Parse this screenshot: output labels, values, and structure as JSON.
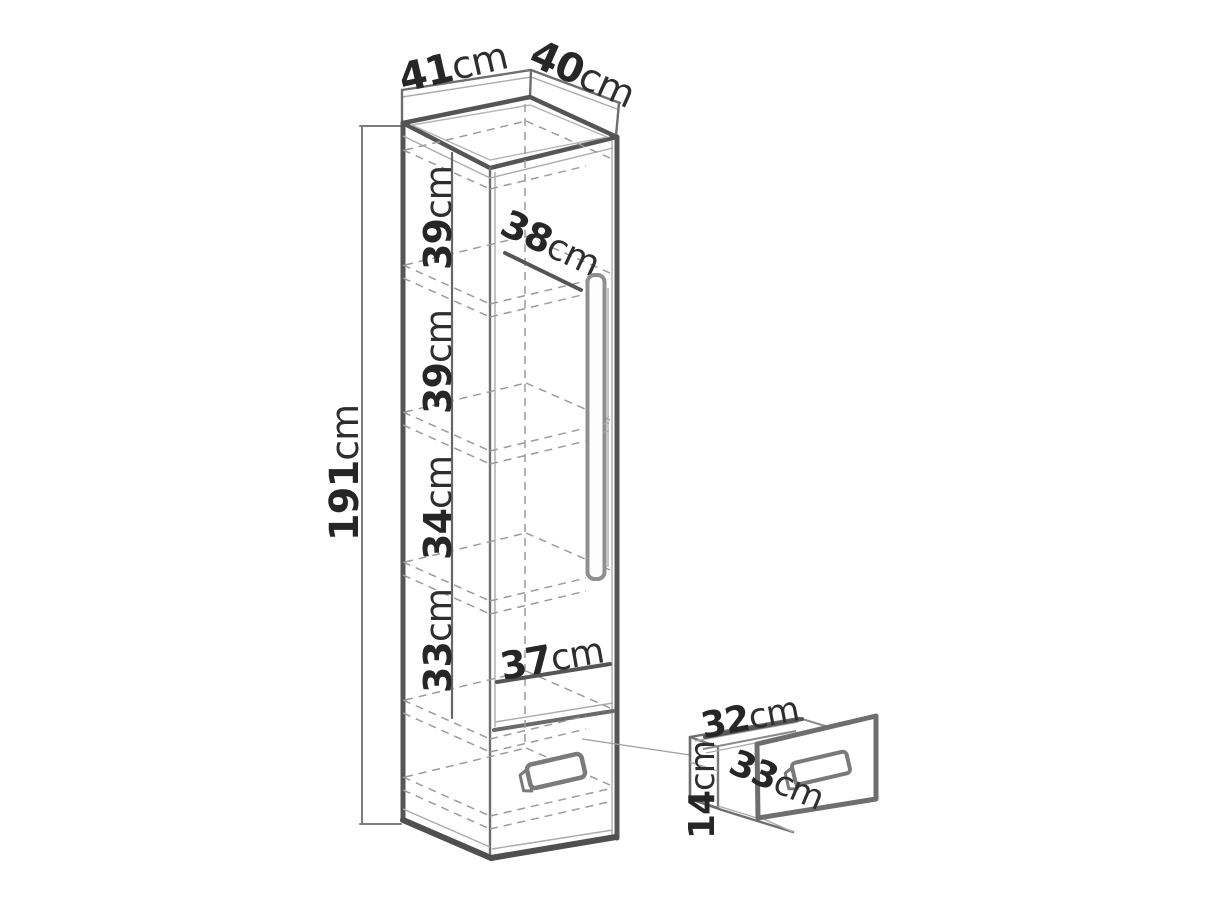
{
  "page": {
    "background": "#ffffff"
  },
  "diagram": {
    "type": "furniture-dimension-drawing",
    "colors": {
      "outline": "#555555",
      "thin_line": "#ababab",
      "dashed_line": "#9b9b9b",
      "dimension_line": "#555555",
      "text": "#262626"
    },
    "cabinet": {
      "width_top": {
        "num": "41",
        "unit": "cm"
      },
      "depth_top": {
        "num": "40",
        "unit": "cm"
      },
      "height": {
        "num": "191",
        "unit": "cm"
      },
      "sections": [
        {
          "num": "39",
          "unit": "cm"
        },
        {
          "num": "39",
          "unit": "cm"
        },
        {
          "num": "34",
          "unit": "cm"
        },
        {
          "num": "33",
          "unit": "cm"
        }
      ],
      "shelf_depth": {
        "num": "38",
        "unit": "cm"
      },
      "interior_width": {
        "num": "37",
        "unit": "cm"
      }
    },
    "drawer": {
      "width": {
        "num": "32",
        "unit": "cm"
      },
      "depth": {
        "num": "33",
        "unit": "cm"
      },
      "height": {
        "num": "14",
        "unit": "cm"
      }
    }
  }
}
